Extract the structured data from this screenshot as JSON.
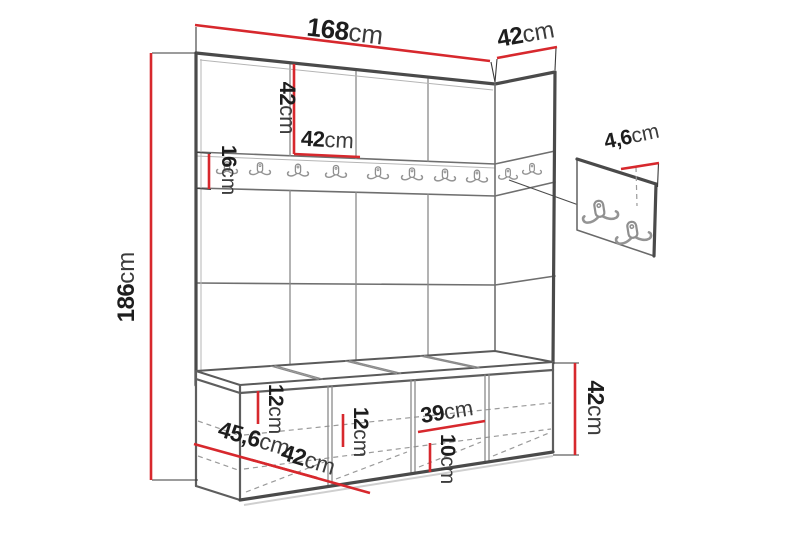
{
  "diagram": {
    "type": "furniture-dimension-diagram",
    "subject": "hallway wardrobe set with panels, hook rail, shoe bench and wall hook panel",
    "colors": {
      "dimension_red": "#d7282d",
      "outline_dark": "#4a4a4a",
      "background": "#ffffff"
    },
    "icons": {
      "coat_hook": "double-prong-wall-hook"
    }
  },
  "labels": {
    "width_top": {
      "value": "168",
      "unit": "cm"
    },
    "depth_top": {
      "value": "42",
      "unit": "cm"
    },
    "height_left": {
      "value": "186",
      "unit": "cm"
    },
    "cabinet_height": {
      "value": "42",
      "unit": "cm"
    },
    "door_width": {
      "value": "42",
      "unit": "cm"
    },
    "rail_height": {
      "value": "16",
      "unit": "cm"
    },
    "panel_hook_depth": {
      "value": "4,6",
      "unit": "cm"
    },
    "bench_gap_top": {
      "value": "12",
      "unit": "cm"
    },
    "bench_gap_mid": {
      "value": "12",
      "unit": "cm"
    },
    "bench_inner_width": {
      "value": "39",
      "unit": "cm"
    },
    "bench_gap_bottom": {
      "value": "10",
      "unit": "cm"
    },
    "bench_depth": {
      "value": "45,6",
      "unit": "cm"
    },
    "bench_section_width": {
      "value": "42",
      "unit": "cm"
    },
    "bench_height": {
      "value": "42",
      "unit": "cm"
    }
  }
}
